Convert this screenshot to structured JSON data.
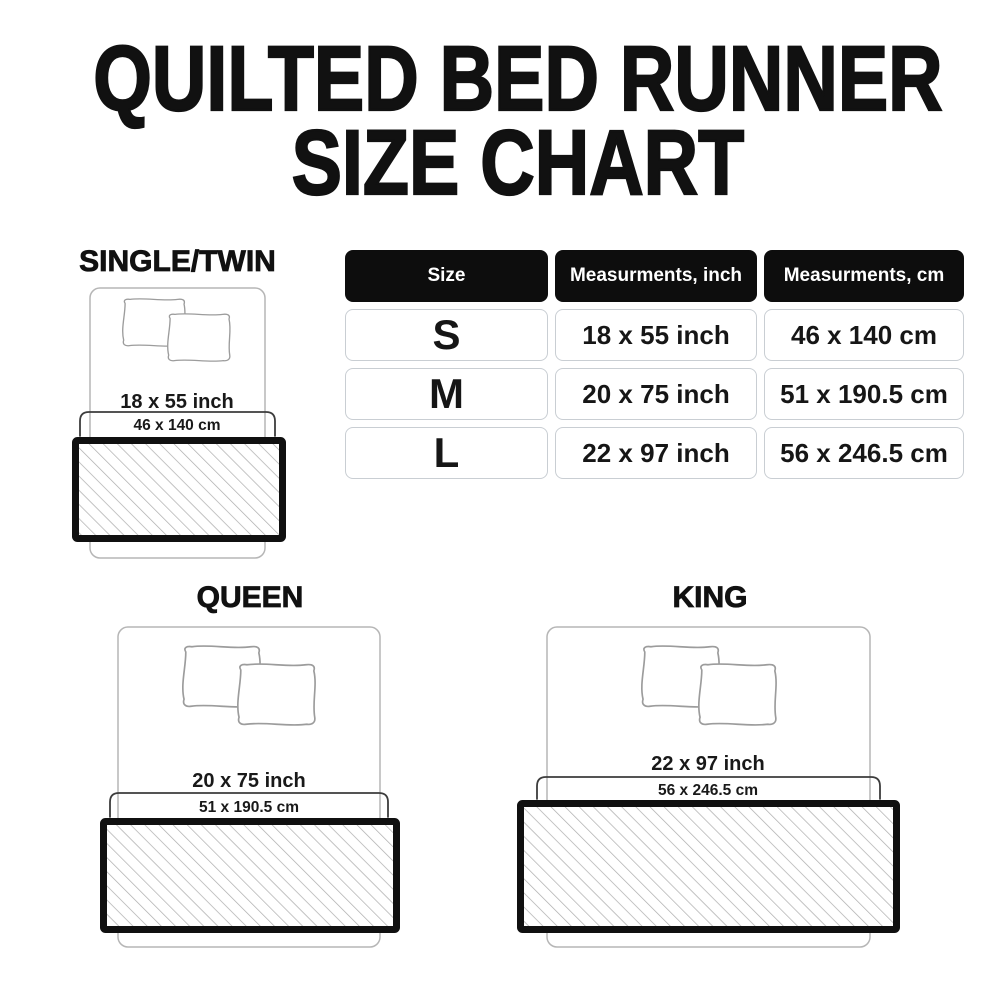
{
  "title": {
    "line1": "QUILTED BED RUNNER",
    "line2": "SIZE CHART"
  },
  "table": {
    "headers": [
      "Size",
      "Measurments, inch",
      "Measurments, cm"
    ],
    "rows": [
      {
        "size": "S",
        "inch": "18 x 55 inch",
        "cm": "46 x 140 cm"
      },
      {
        "size": "M",
        "inch": "20 x 75 inch",
        "cm": "51 x 190.5 cm"
      },
      {
        "size": "L",
        "inch": "22 x 97 inch",
        "cm": "56 x 246.5 cm"
      }
    ]
  },
  "diagrams": {
    "single": {
      "label": "SINGLE/TWIN",
      "inch": "18 x 55 inch",
      "cm": "46 x 140 cm"
    },
    "queen": {
      "label": "QUEEN",
      "inch": "20 x 75 inch",
      "cm": "51 x 190.5 cm"
    },
    "king": {
      "label": "KING",
      "inch": "22 x 97 inch",
      "cm": "56 x 246.5 cm"
    }
  },
  "colors": {
    "background": "#ffffff",
    "text": "#111111",
    "table_header_bg": "#0d0d0d",
    "table_header_text": "#ffffff",
    "cell_border": "#c9ced3",
    "bed_outline": "#b6b6b6",
    "pillow_outline": "#9c9c9c",
    "bracket": "#3c3c3c",
    "runner_border": "#101010",
    "hatch_line": "#ababab"
  }
}
